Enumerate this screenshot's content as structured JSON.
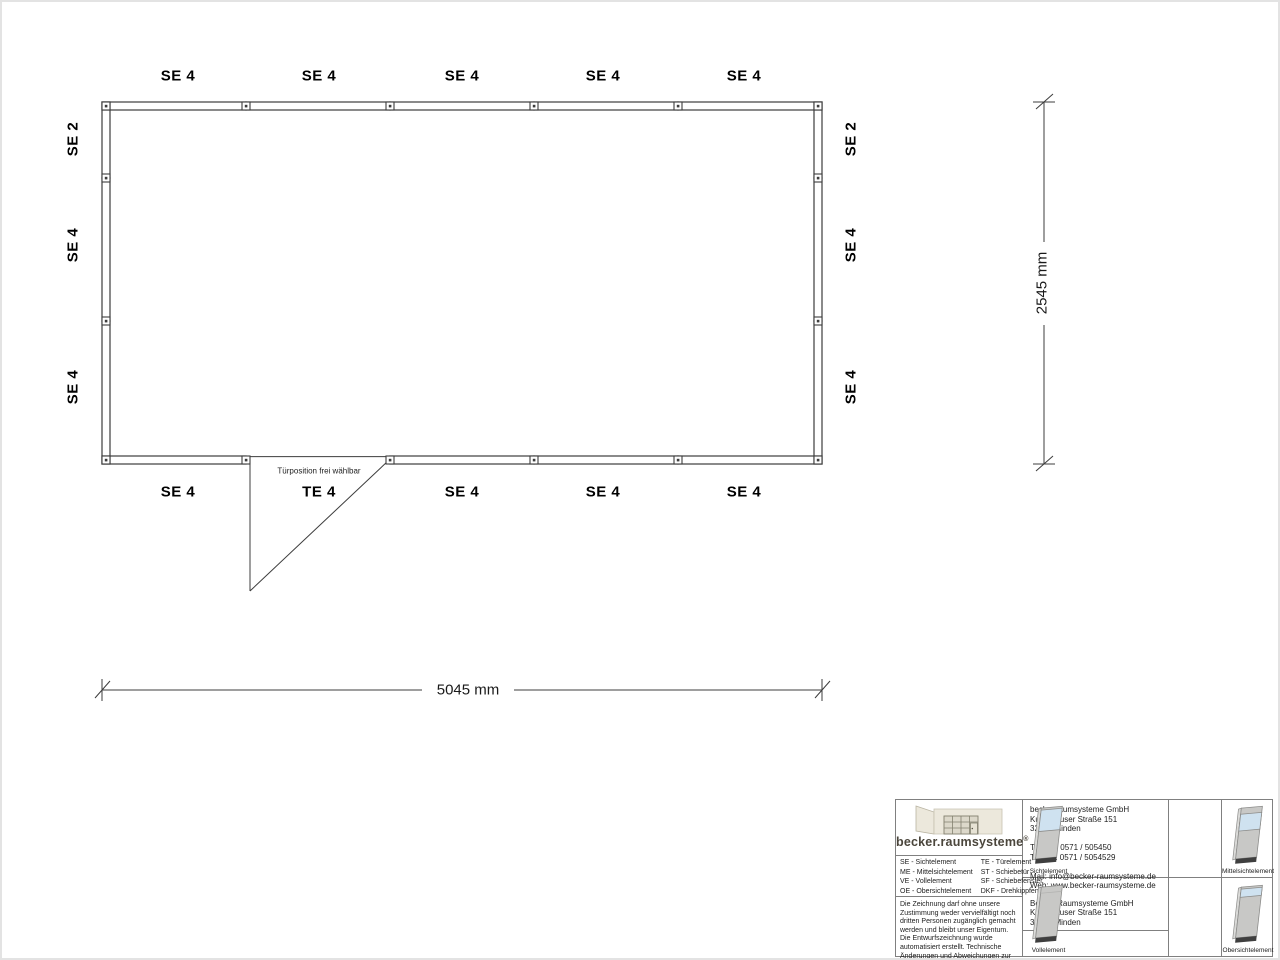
{
  "plan": {
    "top_labels": [
      "SE 4",
      "SE 4",
      "SE 4",
      "SE 4",
      "SE 4"
    ],
    "bottom_labels": [
      "SE 4",
      "TE 4",
      "SE 4",
      "SE 4",
      "SE 4"
    ],
    "left_labels": [
      "SE 2",
      "SE 4",
      "SE 4"
    ],
    "right_labels": [
      "SE 2",
      "SE 4",
      "SE 4"
    ],
    "door_note": "Türposition frei wählbar",
    "dim_width": "5045 mm",
    "dim_height": "2545 mm"
  },
  "titleblock": {
    "logo_text": "becker.raumsysteme",
    "logo_reg": "®",
    "legend": {
      "col1": [
        "SE - Sichtelement",
        "ME - Mittelsichtelement",
        "VE - Vollelement",
        "OE - Obersichtelement"
      ],
      "col2": [
        "TE - Türelement",
        "ST - Schiebetür",
        "SF - Schiebefenster",
        "DKF - Drehkippfenster"
      ]
    },
    "disclaimer": "Die Zeichnung darf ohne unsere Zustimmung weder vervielfältigt noch dritten Personen zugänglich gemacht werden und bleibt unser Eigentum. Die Entwurfszeichnung wurde automatisiert erstellt. Technische Änderungen und Abweichungen zur Ausführungszeichnung behalten wir uns vor.",
    "contact": {
      "company": "becker.raumsysteme GmbH",
      "street": "Kutenhauser Straße 151",
      "city": "32425 Minden",
      "phone": "Telefon: 0571 / 505450",
      "fax": "Telefax: 0571 / 5054529",
      "mail": "Mail: info@becker-raumsysteme.de",
      "web": "Web: www.becker-raumsysteme.de"
    },
    "owner": {
      "company": "Becker Raumsysteme GmbH",
      "street": "Kutenhauser Straße 151",
      "city": "32425 Minden"
    },
    "pictograms": [
      "Sichtelement",
      "Mittelsichtelement",
      "Vollelement",
      "Obersichtelement"
    ],
    "colors": {
      "wall_line": "#3c3c3c",
      "panel_gray": "#c8c8c6",
      "glass_blue": "#cfe2f0",
      "base_dark": "#3f3f3f"
    }
  }
}
